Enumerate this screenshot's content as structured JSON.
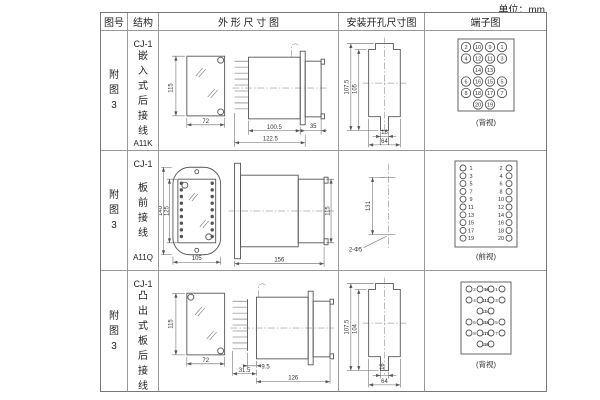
{
  "page": {
    "unit_label": "单位：mm"
  },
  "table": {
    "headers": {
      "fig_no": "图号",
      "structure": "结构",
      "outline": "外 形 尺 寸 图",
      "install": "安装开孔尺寸图",
      "terminal": "端子图"
    }
  },
  "rows": [
    {
      "fig_no": "附图3",
      "series": "CJ-1",
      "structure": "嵌入式后接线",
      "model": "A11K",
      "outline": {
        "front_h": "115",
        "front_w": "72",
        "body_len": "100.5",
        "total_len": "122.5",
        "nose_len": "35"
      },
      "install": {
        "outer_h": "107.5",
        "inner_h": "105",
        "slot_w": "16",
        "bottom_w": "[64]"
      },
      "terminal": {
        "style": "circled-grid",
        "view_label": "(背视)",
        "grid": [
          [
            2,
            10,
            9,
            1
          ],
          [
            4,
            12,
            11,
            3
          ],
          [
            null,
            14,
            13,
            null
          ],
          [
            6,
            16,
            15,
            5
          ],
          [
            8,
            18,
            17,
            7
          ],
          [
            null,
            20,
            19,
            null
          ]
        ]
      }
    },
    {
      "fig_no": "附图3",
      "series": "CJ-1",
      "structure": "板前接线",
      "model": "A11Q",
      "outline": {
        "outer_h": "140",
        "inner_h": "125",
        "front_w": "105",
        "side_len": "156",
        "side_h": "115"
      },
      "install": {
        "hole_dist": "131",
        "holes_label": "2-Φ5"
      },
      "terminal": {
        "style": "screw-rows",
        "view_label": "(前视)",
        "left": [
          1,
          3,
          5,
          7,
          9,
          11,
          13,
          15,
          17,
          19
        ],
        "right": [
          2,
          4,
          6,
          8,
          10,
          12,
          14,
          16,
          18,
          20
        ]
      }
    },
    {
      "fig_no": "附图3",
      "series": "CJ-1",
      "structure": "凸出式板后接线",
      "model": "A11H",
      "outline": {
        "front_h": "115",
        "front_w": "72",
        "gap_len": "9.5",
        "comb_len": "31.5",
        "total_len": "126"
      },
      "install": {
        "outer_h": "107.5",
        "inner_h": "104",
        "slot_w": "16",
        "bottom_w": "64"
      },
      "terminal": {
        "style": "dot-grid",
        "view_label": "(背视)",
        "grid": [
          [
            2,
            10,
            9,
            1
          ],
          [
            4,
            12,
            11,
            3
          ],
          [
            null,
            14,
            13,
            null
          ],
          [
            6,
            16,
            15,
            5
          ],
          [
            8,
            18,
            17,
            7
          ],
          [
            null,
            20,
            19,
            null
          ]
        ]
      }
    }
  ]
}
